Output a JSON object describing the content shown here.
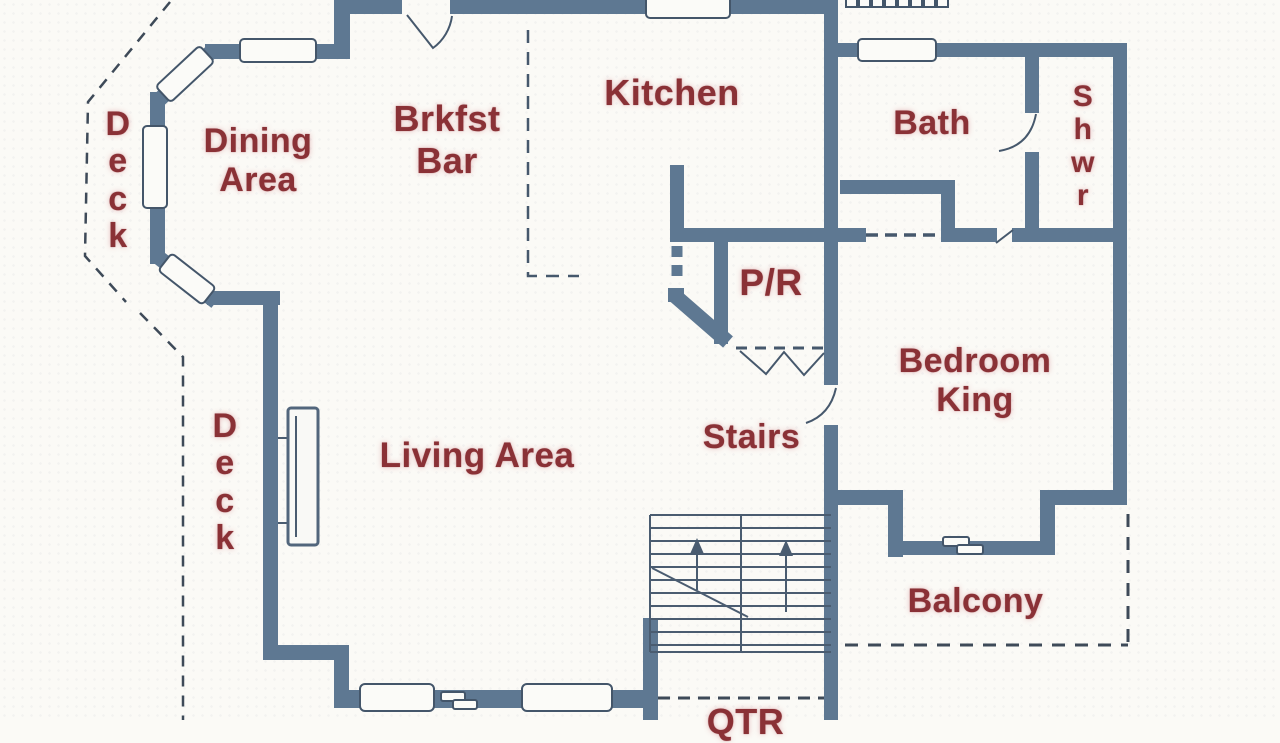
{
  "title": "First floor plan",
  "rooms": {
    "deck_top": {
      "label": "D\ne\nc\nk"
    },
    "dining": {
      "label": "Dining\nArea"
    },
    "brkfst": {
      "label": "Brkfst\nBar"
    },
    "kitchen": {
      "label": "Kitchen"
    },
    "bath": {
      "label": "Bath"
    },
    "shwr": {
      "label": "S\nh\nw\nr"
    },
    "powder_room": {
      "label": "P/R"
    },
    "bedroom": {
      "label": "Bedroom\nKing"
    },
    "deck_left": {
      "label": "D\ne\nc\nk"
    },
    "living": {
      "label": "Living Area"
    },
    "stairs": {
      "label": "Stairs"
    },
    "balcony": {
      "label": "Balcony"
    },
    "qtr": {
      "label": "QTR"
    }
  },
  "colors": {
    "wall": "#5e7892",
    "label_text": "#8a3136",
    "thin_line": "#4a5c70",
    "dashed_line": "#3e4a58",
    "background": "#fbfaf6"
  }
}
